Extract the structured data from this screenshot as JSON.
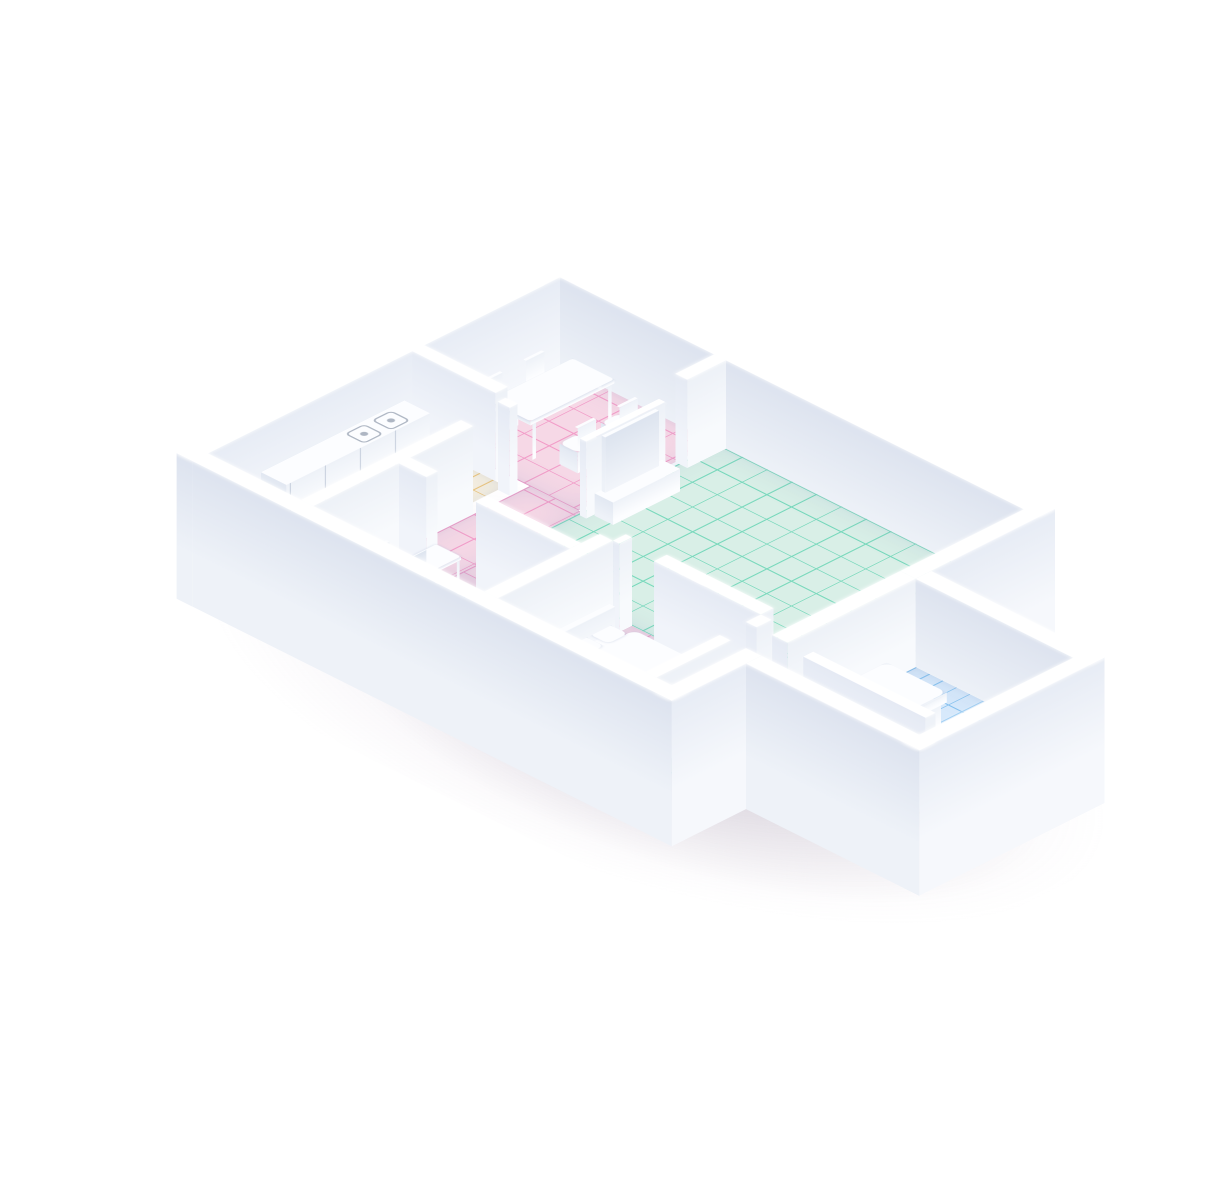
{
  "scene": {
    "description": "Isometric 3D render of an apartment floor plan with white walls on a thick white base, pastel colored room floors, white furniture and a robot vacuum cleaner, casting a soft gray-purple shadow on a white background",
    "projection": "isometric",
    "background": "#ffffff",
    "canvas": {
      "width": 1224,
      "height": 1200
    }
  },
  "rooms": [
    {
      "id": "dining-room",
      "name": "Dining room with hallway",
      "floor_pattern": "square grid tiles",
      "floor_color": "#f6d8e6",
      "line_color": "#f29ec9",
      "furniture": [
        "dining-table",
        "dining-chair x4"
      ]
    },
    {
      "id": "living-room",
      "name": "Living room",
      "floor_pattern": "square grid tiles",
      "floor_color": "#d9efe7",
      "line_color": "#7bd9bd",
      "furniture": [
        "tv-stand",
        "tv",
        "sofa",
        "robot-vacuum"
      ]
    },
    {
      "id": "kitchen",
      "name": "Kitchen",
      "floor_pattern": "brick tiles",
      "floor_color": "#f8f1e1",
      "line_color": "#eec77d",
      "furniture": [
        "kitchen-counter",
        "stove-burner x2"
      ]
    },
    {
      "id": "office",
      "name": "Home office",
      "floor_pattern": "wood planks",
      "floor_color": "#cfe4f8",
      "line_color": "#6cb4e9",
      "furniture": [
        "desk",
        "office-chair",
        "laptop"
      ]
    },
    {
      "id": "bedroom-main",
      "name": "Main bedroom",
      "floor_pattern": "square grid tiles",
      "floor_color": "#f8dcea",
      "line_color": "#f09fcb",
      "furniture": [
        "double-bed",
        "pillow x2",
        "duvet"
      ]
    },
    {
      "id": "bedroom-second",
      "name": "Second bedroom (right wing)",
      "floor_pattern": "brick planks",
      "floor_color": "#d7e9fb",
      "line_color": "#8ac4f0",
      "furniture": [
        "bed",
        "pillow x2",
        "duvet"
      ]
    },
    {
      "id": "bathroom-corridor",
      "name": "Bathroom corridor",
      "floor_pattern": "striped tiles",
      "floor_color": "#f6efdc",
      "line_color": "#eed584",
      "furniture": [
        "toilet"
      ]
    }
  ],
  "robot": {
    "name": "robot-vacuum",
    "location": "living-room",
    "body_color": "#ffffff"
  },
  "colors": {
    "wall_top": "#ffffff",
    "wall_se_light": "#f6f8fc",
    "wall_se_shade": "#e7ecf5",
    "wall_sw_light": "#eef2f8",
    "wall_sw_shade": "#dde3ef",
    "iw_se_light": "#f8fafd",
    "iw_se_shade": "#edf1f7",
    "iw_sw_light": "#f1f4fa",
    "iw_sw_shade": "#e5eaf4",
    "pink_floor": "#f6d8e6",
    "pink_line": "#f29ec9",
    "mint_floor": "#d9efe7",
    "mint_line": "#7bd9bd",
    "kitchen_floor": "#f8f1e1",
    "kitchen_line": "#eec77d",
    "office_floor": "#cfe4f8",
    "office_line": "#6cb4e9",
    "pinkbed_floor": "#f8dcea",
    "pinkbed_line": "#f09fcb",
    "bluebed_floor": "#d7e9fb",
    "bluebed_line": "#8ac4f0",
    "bath_floor": "#f6efdc",
    "bath_line": "#eed584",
    "furn_top": "#fcfdff",
    "furn_se": "#eef2f8",
    "furn_sw": "#e2e8f2",
    "tv_screen_a": "#f2f5fa",
    "tv_screen_b": "#dde4ef",
    "burner": "#9aa4b4",
    "shadow_core": "rgba(95,95,105,0.50)",
    "shadow_mid": "rgba(135,125,145,0.33)",
    "shadow_tint": "rgba(168,140,178,0.22)"
  }
}
